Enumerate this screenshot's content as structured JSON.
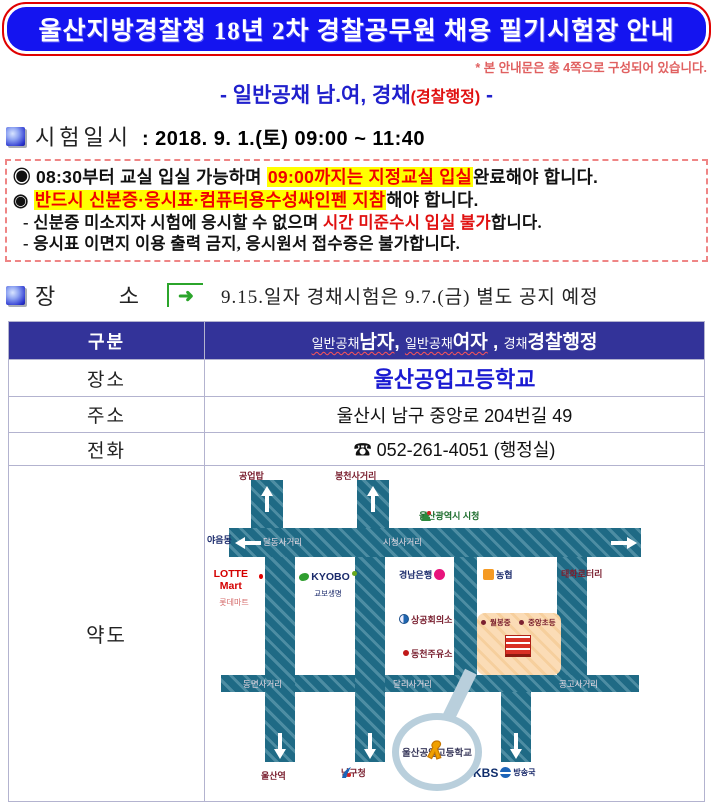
{
  "page": {
    "title": "울산지방경찰청 18년 2차 경찰공무원 채용 필기시험장 안내",
    "note": "* 본 안내문은 총 4쪽으로 구성되어 있습니다.",
    "subtitle_pre": "- 일반공채 남.여, 경채",
    "subtitle_paren": "(경찰행정)",
    "subtitle_post": " -"
  },
  "exam_time": {
    "heading": "시험일시",
    "value": ": 2018. 9. 1.(토) 09:00 ~ 11:40"
  },
  "notices": {
    "line1_pre": "◉ 08:30부터 교실 입실 가능하며 ",
    "line1_mark": "09:00까지는 지정교실 입실",
    "line1_post": "완료해야 합니다.",
    "line2_pre": "◉ ",
    "line2_mark": "반드시 신분증·응시표·컴퓨터용수성싸인펜 지참",
    "line2_post": "해야 합니다.",
    "line3_pre": "- 신분증 미소지자 시험에 응시할 수 없으며 ",
    "line3_red": "시간 미준수시 입실 불가",
    "line3_post": "합니다.",
    "line4": "- 응시표 이면지 이용 출력 금지, 응시원서 접수증은 불가합니다."
  },
  "location": {
    "heading": "장 소",
    "arrow_glyph": "➜",
    "notice": "9.15.일자 경채시험은 9.7.(금) 별도 공지 예정"
  },
  "table": {
    "gubun_label": "구분",
    "gubun_small1": "일반공채",
    "gubun_big1": "남자",
    "gubun_sep1": ", ",
    "gubun_small2": "일반공채",
    "gubun_big2": "여자",
    "gubun_sep2": " , ",
    "gubun_small3": "경채",
    "gubun_big3": "경찰행정",
    "place_label": "장소",
    "place_value": "울산공업고등학교",
    "addr_label": "주소",
    "addr_value": "울산시 남구 중앙로 204번길 49",
    "tel_label": "전화",
    "tel_icon": "☎",
    "tel_value": "052-261-4051 (행정실)",
    "map_label": "약도"
  },
  "map": {
    "top_exit1": "공업탑",
    "top_exit2": "봉천사거리",
    "cityhall": "울산광역시 시청",
    "left_exit": "야음동",
    "cross1": "달동사거리",
    "cross2": "시청사거리",
    "right_exit": "태화로터리",
    "lotte": "LOTTE Mart",
    "lotte_sub": "롯데마트",
    "kyobo": "KYOBO",
    "kyobo_sub": "교보생명",
    "knbank": "경남은행",
    "nonghyup": "농협",
    "chamber": "상공회의소",
    "gas": "동천주유소",
    "school1": "월봉중",
    "school2": "중앙초등",
    "bcross1": "동면사거리",
    "bcross2": "달리사거리",
    "bcross3": "공고사거리",
    "dest1": "울산역",
    "dest2": "남구청",
    "dest3": "KBS",
    "dest3_sub": "방송국",
    "target": "울산공업고등학교"
  },
  "colors": {
    "title_bg": "#1414f0",
    "title_border": "#e00000",
    "highlight": "#ffff00",
    "alert_red": "#f00000",
    "header_bg": "#333399",
    "link_blue": "#1a1ad1",
    "road_teal": "#1f6a85",
    "callout_blue": "#b9cfdc"
  }
}
